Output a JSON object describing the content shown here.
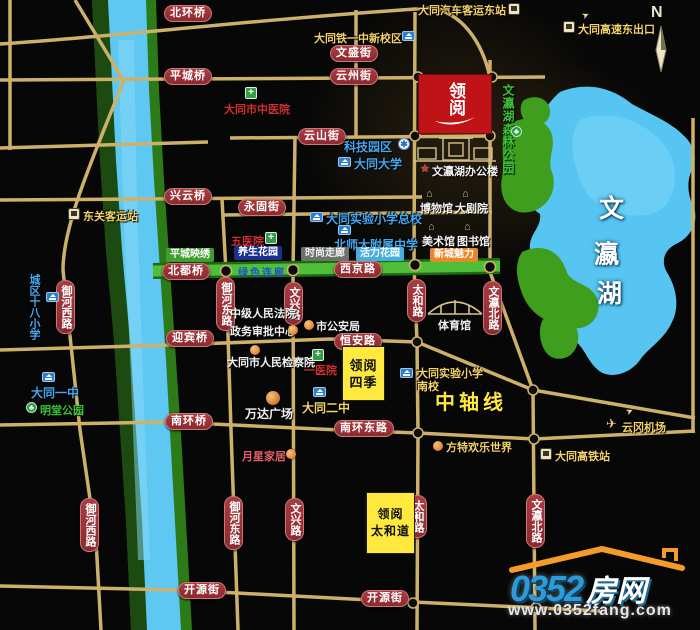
{
  "colors": {
    "pill_red": "#9e3338",
    "project_red": "#bf1318",
    "project_yellow": "#ffe93f",
    "road_gold": "#cdb06a",
    "water_blue": "#5ec7f2",
    "park_green": "#3f9e1d",
    "poi_blue": "#45a7ef",
    "poi_yellow": "#f3d26a"
  },
  "compass": {
    "label": "N"
  },
  "project": {
    "main": "领阅",
    "siji_line1": "领阅",
    "siji_line2": "四季",
    "taihedao_line1": "领阅",
    "taihedao_line2": "太和道"
  },
  "lake": {
    "chars": [
      "文",
      "瀛",
      "湖"
    ],
    "forest_park": "文瀛湖森林公园"
  },
  "roads": {
    "beihuanqiao": "北环桥",
    "pingchengqiao": "平城桥",
    "wenshengjie": "文盛街",
    "yunzhoujie": "云州街",
    "yunshanjie": "云山街",
    "xingyunqiao": "兴云桥",
    "yonggujie": "永固街",
    "beiduqiao": "北都桥",
    "xijinglu": "西京路",
    "yingbinqiao": "迎宾桥",
    "henganlu": "恒安路",
    "nanhuanqiao": "南环桥",
    "nanhuandonglu": "南环东路",
    "kaiyuanjie": "开源街",
    "yuhexilu": "御河西路",
    "yuhedonglu": "御河东路",
    "wenxinglu": "文兴路",
    "taihelu": "太和路",
    "wenyingbeilu": "文瀛北路"
  },
  "places": {
    "bus_east": "大同汽车客运东站",
    "highway_exit": "大同高速东出口",
    "tieyizhong": "大同铁一中新校区",
    "zhongyiyuan": "大同市中医院",
    "kejiyuanqu": "科技园区",
    "datongdaxue": "大同大学",
    "dongguanzhan": "东关客运站",
    "wuyiyuan": "五医院",
    "shiyanzongxiao": "大同实验小学总校",
    "beishida": "北师大附属中学",
    "bangonglou": "文瀛湖办公楼",
    "bowuguan": "博物馆",
    "dajuyuan": "大剧院",
    "meishuguan": "美术馆",
    "tushuguan": "图书馆",
    "tiyuguan": "体育馆",
    "chengqushibaxiao": "城区十八小学",
    "fayuan": "中级人民法院",
    "zhengwu": "政务审批中心",
    "gonganju": "市公安局",
    "jianchayuan": "大同市人民检察院",
    "yiyiyuan": "一医院",
    "datongyizhong": "大同一中",
    "mingtang": "明堂公园",
    "datongerzhong": "大同二中",
    "wanda": "万达广场",
    "shiyannan_line1": "大同实验小学",
    "shiyannan_line2": "南校",
    "zhongzhouxian": "中轴线",
    "fangte": "方特欢乐世界",
    "yungang": "云冈机场",
    "gaotiezhan": "大同高铁站",
    "yuexing": "月星家居"
  },
  "zones": {
    "pingchengyingxiu": "平城映绣",
    "yangsheng": "养生花园",
    "shishang": "时尚走廊",
    "huoli": "活力花园",
    "xincheng": "新城魅力",
    "lvselianlang": "绿色连廊"
  },
  "logo": {
    "number": "0352",
    "suffix": "房网",
    "url": "www.0352fang.com"
  }
}
